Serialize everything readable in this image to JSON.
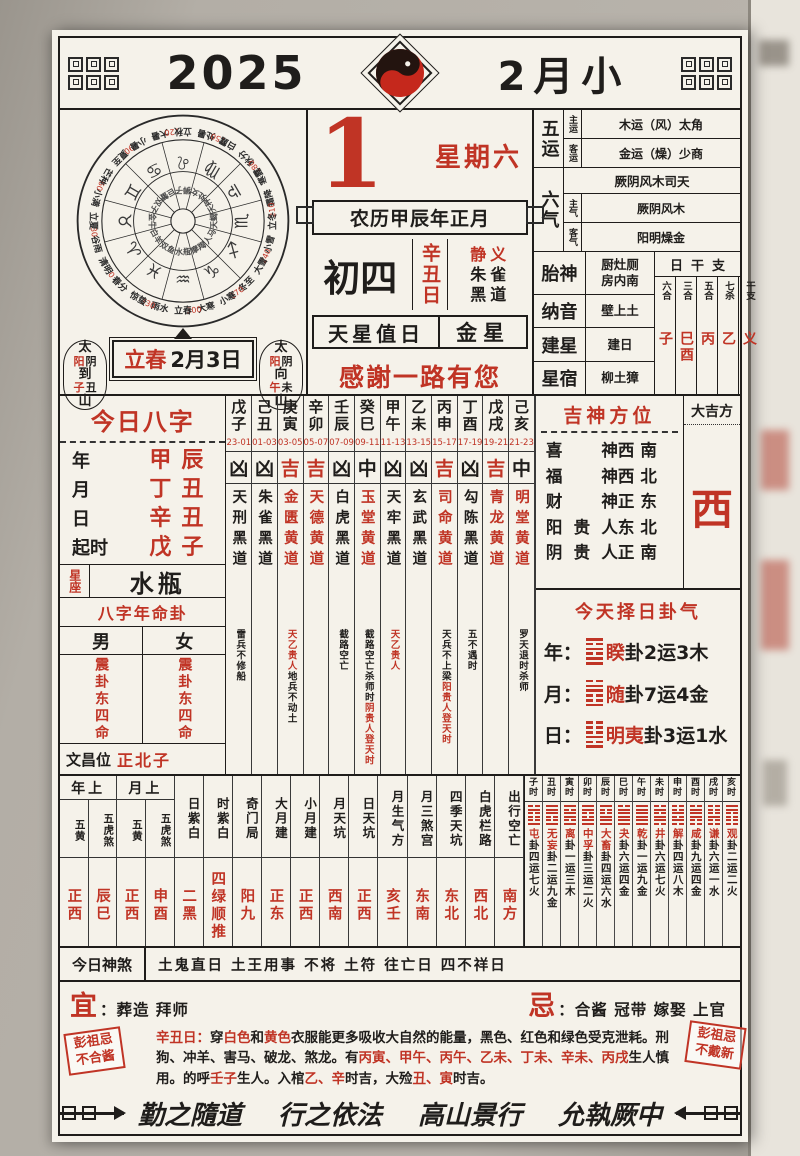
{
  "colors": {
    "red": "#c03425",
    "ink": "#1f1d1b",
    "paper": "#f5f2ea"
  },
  "header": {
    "year": "2025",
    "month_title": "2月小"
  },
  "wheel": {
    "terms": [
      {
        "name": "春分",
        "deg": 0,
        "num": "0"
      },
      {
        "name": "清明",
        "deg": 15
      },
      {
        "name": "谷雨",
        "deg": 30,
        "num": "30"
      },
      {
        "name": "立夏",
        "deg": 45
      },
      {
        "name": "小满",
        "deg": 60,
        "num": "60"
      },
      {
        "name": "芒种",
        "deg": 75
      },
      {
        "name": "夏至",
        "deg": 90,
        "num": "90"
      },
      {
        "name": "小暑",
        "deg": 105
      },
      {
        "name": "大暑",
        "deg": 120,
        "num": "120"
      },
      {
        "name": "立秋",
        "deg": 135
      },
      {
        "name": "处暑",
        "deg": 150,
        "num": "150"
      },
      {
        "name": "白露",
        "deg": 165
      },
      {
        "name": "秋分",
        "deg": 180,
        "num": "180"
      },
      {
        "name": "寒露",
        "deg": 195
      },
      {
        "name": "霜降",
        "deg": 210,
        "num": "210"
      },
      {
        "name": "立冬",
        "deg": 225
      },
      {
        "name": "小雪",
        "deg": 240,
        "num": "240"
      },
      {
        "name": "大雪",
        "deg": 255
      },
      {
        "name": "冬至",
        "deg": 270,
        "num": "270"
      },
      {
        "name": "小寒",
        "deg": 285
      },
      {
        "name": "大寒",
        "deg": 300,
        "num": "300"
      },
      {
        "name": "立春",
        "deg": 315
      },
      {
        "name": "雨水",
        "deg": 330,
        "num": "330"
      },
      {
        "name": "惊蛰",
        "deg": 345
      }
    ],
    "signs": [
      {
        "name": "白羊",
        "glyph": "♈",
        "deg": 15
      },
      {
        "name": "金牛",
        "glyph": "♉",
        "deg": 45
      },
      {
        "name": "双子",
        "glyph": "♊",
        "deg": 75
      },
      {
        "name": "巨蟹",
        "glyph": "♋",
        "deg": 105
      },
      {
        "name": "狮子",
        "glyph": "♌",
        "deg": 135
      },
      {
        "name": "处女",
        "glyph": "♍",
        "deg": 165
      },
      {
        "name": "天秤",
        "glyph": "♎",
        "deg": 195
      },
      {
        "name": "天蝎",
        "glyph": "♏",
        "deg": 225
      },
      {
        "name": "人马",
        "glyph": "♐",
        "deg": 255
      },
      {
        "name": "摩羯",
        "glyph": "♑",
        "deg": 285
      },
      {
        "name": "水瓶",
        "glyph": "♒",
        "deg": 315
      },
      {
        "name": "双鱼",
        "glyph": "♓",
        "deg": 345
      }
    ]
  },
  "sun_moon": {
    "left": [
      {
        "t": "太"
      },
      {
        "a": "阳",
        "b": "阴"
      },
      {
        "t": "到"
      },
      {
        "a": "子",
        "b": "丑"
      },
      {
        "t": "山"
      }
    ],
    "right": [
      {
        "t": "太"
      },
      {
        "a": "阳",
        "b": "阴"
      },
      {
        "t": "向"
      },
      {
        "a": "午",
        "b": "未"
      },
      {
        "t": "山"
      }
    ]
  },
  "spring": {
    "term": "立春",
    "date": "2月3日"
  },
  "main": {
    "day_number": "1",
    "weekday": "星期六",
    "lunar_line": "农历甲辰年正月",
    "lunar_day": "初四",
    "ganzhi_day": "辛丑日",
    "jing_yi": "静义",
    "zhuque_1": "朱雀",
    "zhuque_2": "黑道",
    "tianxing_label": "天星值日",
    "tianxing_value": "金星",
    "greeting": "感謝一路有您"
  },
  "right_panel": {
    "wuyun": {
      "label": "五运",
      "rows": [
        {
          "k": "主运",
          "v": "木运（风）太角"
        },
        {
          "k": "客运",
          "v": "金运（燥）少商"
        }
      ]
    },
    "liuqi": {
      "label": "六气",
      "top": "厥阴风木司天",
      "rows": [
        {
          "k": "主气",
          "v": "厥阴风木"
        },
        {
          "k": "客气",
          "v": "阳明燥金"
        }
      ]
    },
    "taishen": {
      "label": "胎神",
      "v1": "厨灶厕",
      "v2": "房内南"
    },
    "nayin": {
      "label": "纳音",
      "value": "壁上土"
    },
    "jianxing": {
      "label": "建星",
      "value": "建日"
    },
    "xingxiu": {
      "label": "星宿",
      "value": "柳土獐"
    },
    "ganzhi_table": {
      "title": "日干支",
      "cols": [
        {
          "h": "六合",
          "v": "子"
        },
        {
          "h": "三合",
          "v": "巳酉"
        },
        {
          "h": "五合",
          "v": "丙"
        },
        {
          "h": "七杀",
          "v": "乙"
        },
        {
          "h": "干支",
          "v": "义"
        }
      ]
    }
  },
  "bazi": {
    "title": "今日八字",
    "rows": [
      {
        "k": "年",
        "v": "甲辰"
      },
      {
        "k": "月",
        "v": "丁丑"
      },
      {
        "k": "日",
        "v": "辛丑"
      },
      {
        "k": "起时",
        "v": "戊子"
      }
    ],
    "xingzuo_label": "星座",
    "xingzuo": "水瓶",
    "mingua_title": "八字年命卦",
    "male": "男",
    "female": "女",
    "male_gua": "震卦东四命",
    "female_gua": "震卦东四命",
    "wenchang_label": "文昌位",
    "wenchang": "正北子"
  },
  "hours": [
    {
      "gz": "戊子",
      "time": "23-01",
      "luck": "凶",
      "god": "天刑黑道",
      "god_red": false,
      "note": [
        {
          "t": "雷兵不修船",
          "red": false
        }
      ]
    },
    {
      "gz": "己丑",
      "time": "01-03",
      "luck": "凶",
      "god": "朱雀黑道",
      "god_red": false,
      "note": []
    },
    {
      "gz": "庚寅",
      "time": "03-05",
      "luck": "吉",
      "god": "金匮黄道",
      "god_red": true,
      "note": [
        {
          "t": "天乙贵人",
          "red": true
        },
        {
          "t": "地兵不动土",
          "red": false
        }
      ]
    },
    {
      "gz": "辛卯",
      "time": "05-07",
      "luck": "吉",
      "god": "天德黄道",
      "god_red": true,
      "note": []
    },
    {
      "gz": "壬辰",
      "time": "07-09",
      "luck": "凶",
      "god": "白虎黑道",
      "god_red": false,
      "note": [
        {
          "t": "截路空亡",
          "red": false
        }
      ]
    },
    {
      "gz": "癸巳",
      "time": "09-11",
      "luck": "中",
      "god": "玉堂黄道",
      "god_red": true,
      "note": [
        {
          "t": "截路空亡杀师时",
          "red": false
        },
        {
          "t": "阴贵人登天时",
          "red": true
        }
      ]
    },
    {
      "gz": "甲午",
      "time": "11-13",
      "luck": "凶",
      "god": "天牢黑道",
      "god_red": false,
      "note": [
        {
          "t": "天乙贵人",
          "red": true
        }
      ]
    },
    {
      "gz": "乙未",
      "time": "13-15",
      "luck": "凶",
      "god": "玄武黑道",
      "god_red": false,
      "note": []
    },
    {
      "gz": "丙申",
      "time": "15-17",
      "luck": "吉",
      "god": "司命黄道",
      "god_red": true,
      "note": [
        {
          "t": "天兵不上梁",
          "red": false
        },
        {
          "t": "阳贵人登天时",
          "red": true
        }
      ]
    },
    {
      "gz": "丁酉",
      "time": "17-19",
      "luck": "凶",
      "god": "勾陈黑道",
      "god_red": false,
      "note": [
        {
          "t": "五不遇时",
          "red": false
        }
      ]
    },
    {
      "gz": "戊戌",
      "time": "19-21",
      "luck": "吉",
      "god": "青龙黄道",
      "god_red": true,
      "note": []
    },
    {
      "gz": "己亥",
      "time": "21-23",
      "luck": "中",
      "god": "明堂黄道",
      "god_red": true,
      "note": [
        {
          "t": "罗天退时杀师",
          "red": false
        }
      ]
    }
  ],
  "jishen": {
    "title": "吉神方位",
    "rows": [
      {
        "k": "喜神",
        "v": "西南"
      },
      {
        "k": "福神",
        "v": "西北"
      },
      {
        "k": "财神",
        "v": "正东"
      },
      {
        "k": "阳贵人",
        "v": "东北"
      },
      {
        "k": "阴贵人",
        "v": "正南"
      }
    ],
    "daji_label": "大吉方",
    "daji": "西"
  },
  "guaqi": {
    "title": "今天择日卦气",
    "rows": [
      {
        "k": "年：",
        "hex": [
          1,
          1,
          0,
          1,
          0,
          1
        ],
        "name": "睽",
        "rest": "卦2运3木"
      },
      {
        "k": "月：",
        "hex": [
          1,
          0,
          0,
          1,
          1,
          0
        ],
        "name": "随",
        "rest": "卦7运4金"
      },
      {
        "k": "日：",
        "hex": [
          1,
          0,
          1,
          0,
          0,
          0
        ],
        "name": "明夷",
        "rest": "卦3运1水"
      }
    ]
  },
  "lower_table": {
    "groups": [
      {
        "h": "年上",
        "cols": [
          {
            "h": "五黄",
            "v": "正西"
          },
          {
            "h": "五虎煞",
            "v": "辰巳"
          }
        ]
      },
      {
        "h": "月上",
        "cols": [
          {
            "h": "五黄",
            "v": "正西"
          },
          {
            "h": "五虎煞",
            "v": "申酉"
          }
        ]
      }
    ],
    "cols": [
      {
        "h": "日紫白",
        "v": "二黑"
      },
      {
        "h": "时紫白",
        "v": "四绿顺推"
      },
      {
        "h": "奇门局",
        "v": "阳九"
      },
      {
        "h": "大月建",
        "v": "正东"
      },
      {
        "h": "小月建",
        "v": "正西"
      },
      {
        "h": "月天坑",
        "v": "西南"
      },
      {
        "h": "日天坑",
        "v": "正西"
      },
      {
        "h": "月生气方",
        "v": "亥壬"
      },
      {
        "h": "月三煞宫",
        "v": "东南"
      },
      {
        "h": "四季天坑",
        "v": "东北"
      },
      {
        "h": "白虎栏路",
        "v": "西北"
      },
      {
        "h": "出行空亡",
        "v": "南方"
      }
    ]
  },
  "hour_gua": [
    {
      "h": "子时",
      "hex": [
        1,
        0,
        0,
        0,
        1,
        0
      ],
      "name": "屯",
      "rest": "卦四运七火"
    },
    {
      "h": "丑时",
      "hex": [
        1,
        0,
        0,
        1,
        1,
        1
      ],
      "name": "无妄",
      "rest": "卦二运九金"
    },
    {
      "h": "寅时",
      "hex": [
        1,
        0,
        1,
        1,
        0,
        1
      ],
      "name": "离",
      "rest": "卦一运三木"
    },
    {
      "h": "卯时",
      "hex": [
        1,
        1,
        0,
        0,
        1,
        1
      ],
      "name": "中孚",
      "rest": "卦三运二火"
    },
    {
      "h": "辰时",
      "hex": [
        1,
        1,
        1,
        0,
        0,
        1
      ],
      "name": "大畜",
      "rest": "卦四运六水"
    },
    {
      "h": "巳时",
      "hex": [
        1,
        1,
        1,
        1,
        1,
        0
      ],
      "name": "夬",
      "rest": "卦六运四金"
    },
    {
      "h": "午时",
      "hex": [
        1,
        1,
        1,
        1,
        1,
        1
      ],
      "name": "乾",
      "rest": "卦一运九金"
    },
    {
      "h": "未时",
      "hex": [
        0,
        1,
        1,
        0,
        1,
        0
      ],
      "name": "井",
      "rest": "卦六运七火"
    },
    {
      "h": "申时",
      "hex": [
        0,
        1,
        0,
        1,
        0,
        0
      ],
      "name": "解",
      "rest": "卦四运八木"
    },
    {
      "h": "酉时",
      "hex": [
        0,
        0,
        1,
        1,
        1,
        0
      ],
      "name": "咸",
      "rest": "卦九运四金"
    },
    {
      "h": "戌时",
      "hex": [
        0,
        0,
        1,
        0,
        0,
        0
      ],
      "name": "谦",
      "rest": "卦六运一水"
    },
    {
      "h": "亥时",
      "hex": [
        0,
        0,
        0,
        0,
        1,
        1
      ],
      "name": "观",
      "rest": "卦二运二火"
    }
  ],
  "shensha": {
    "label": "今日神煞",
    "text": "土鬼直日 土王用事 不将 土符 往亡日 四不祥日"
  },
  "yiji": {
    "yi_label": "宜",
    "yi": "：葬造 拜师",
    "ji_label": "忌",
    "ji": "：合酱 冠带 嫁娶 上官"
  },
  "seal_left": {
    "text": "彭祖忌\n不合酱"
  },
  "seal_right": {
    "text": "彭祖忌\n不戴新"
  },
  "footer_para": [
    {
      "t": "辛丑日：",
      "red": true
    },
    {
      "t": "穿",
      "red": false
    },
    {
      "t": "白色",
      "red": true
    },
    {
      "t": "和",
      "red": false
    },
    {
      "t": "黄色",
      "red": true
    },
    {
      "t": "衣服能更多吸收大自然的能量，黑色、红色和绿色受克泄耗。刑狗、冲羊、害马、破龙、煞龙。有",
      "red": false
    },
    {
      "t": "丙寅、甲午、丙午、乙未、丁未、辛未、丙戌",
      "red": true
    },
    {
      "t": "生人慎用。的呼",
      "red": false
    },
    {
      "t": "壬子",
      "red": true
    },
    {
      "t": "生人。入棺",
      "red": false
    },
    {
      "t": "乙、辛",
      "red": true
    },
    {
      "t": "时吉，大殓",
      "red": false
    },
    {
      "t": "丑、寅",
      "red": true
    },
    {
      "t": "时吉。",
      "red": false
    }
  ],
  "motto": [
    "勤之隨道",
    "行之依法",
    "高山景行",
    "允執厥中"
  ]
}
